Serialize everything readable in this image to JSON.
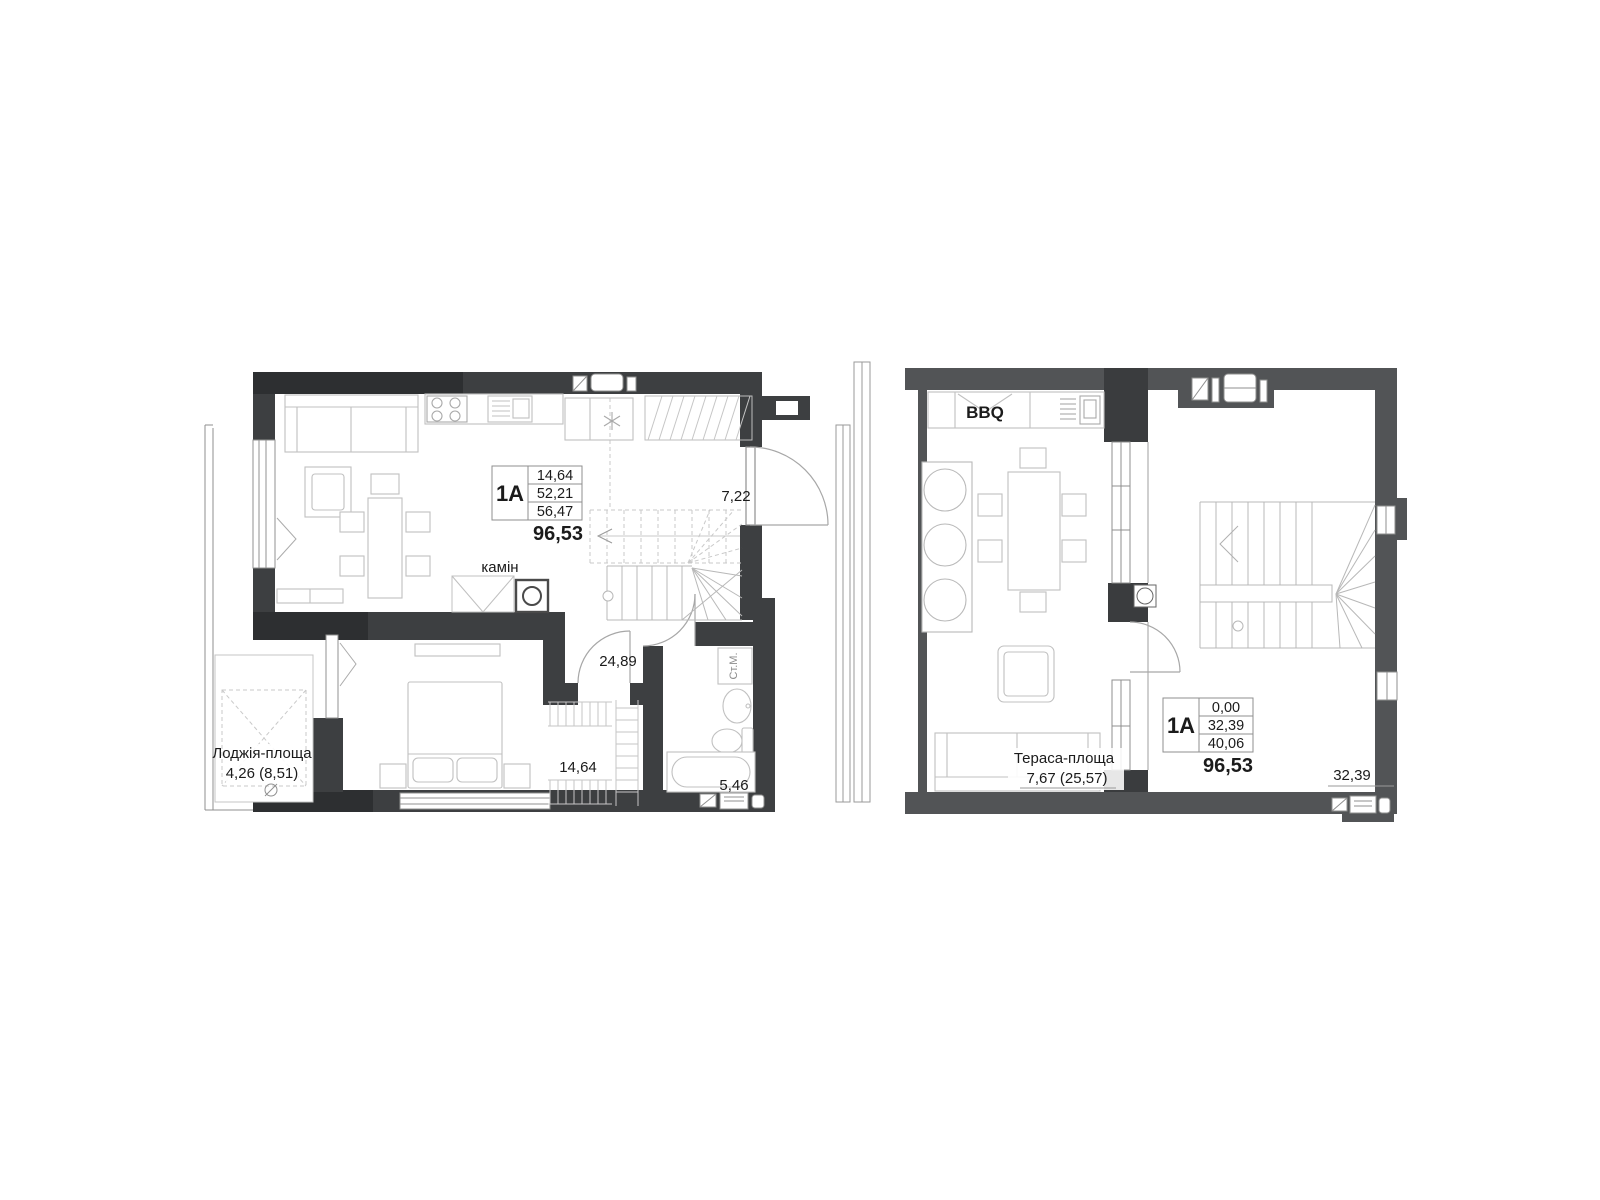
{
  "left_plan": {
    "spec_table": {
      "unit": "1A",
      "values": [
        "14,64",
        "52,21",
        "56,47"
      ],
      "total": "96,53"
    },
    "labels": {
      "fireplace": "камін",
      "entry_area": "7,22",
      "hall_area": "24,89",
      "bedroom_area": "14,64",
      "bathroom_area": "5,46",
      "washer": "Ст.М.",
      "loggia_title": "Лоджія-площа",
      "loggia_value": "4,26 (8,51)"
    }
  },
  "right_plan": {
    "spec_table": {
      "unit": "1A",
      "values": [
        "0,00",
        "32,39",
        "40,06"
      ],
      "total": "96,53"
    },
    "labels": {
      "bbq": "BBQ",
      "terrace_title": "Тераса-площа",
      "terrace_value": "7,67 (25,57)",
      "room_area": "32,39"
    }
  },
  "colors": {
    "wall_dark": "#3d3f41",
    "wall_darker": "#2d2f31",
    "wall_medium": "#525456",
    "furniture_line": "#c0c0c0",
    "stair_line": "#b8b8b8",
    "dashed_line": "#c9c9c9",
    "text": "#1b1b1b"
  }
}
